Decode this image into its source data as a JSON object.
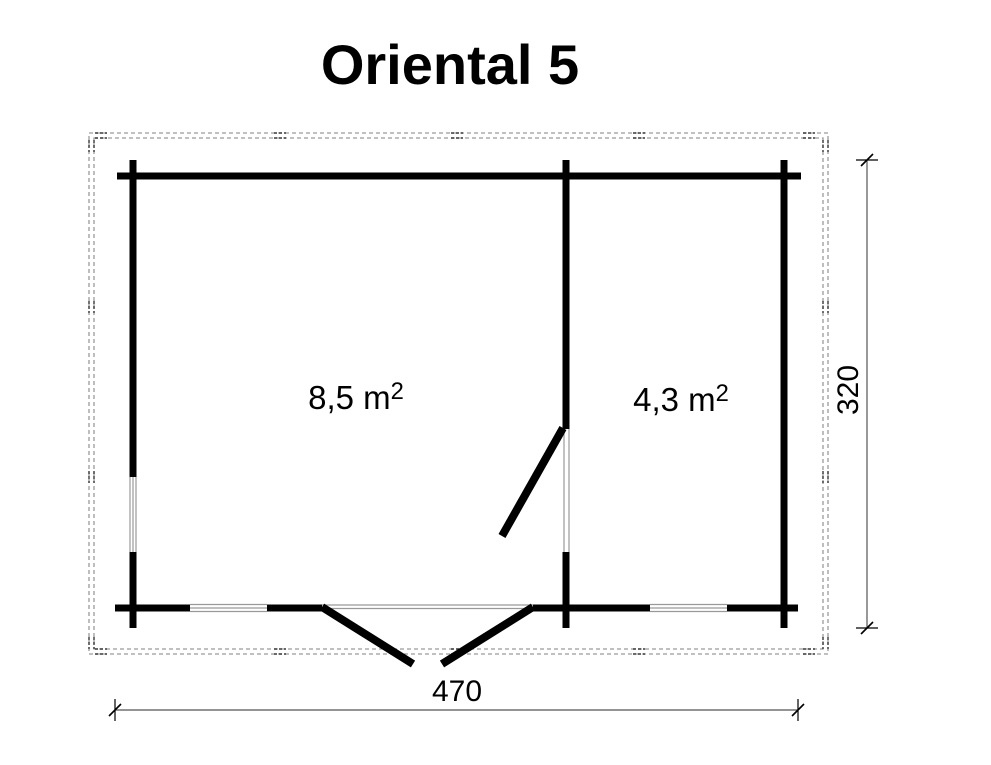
{
  "title": "Oriental 5",
  "rooms": [
    {
      "id": "main-room",
      "area_label": "8,5 m",
      "area_exponent": "2"
    },
    {
      "id": "second-room",
      "area_label": "4,3 m",
      "area_exponent": "2"
    }
  ],
  "dimensions": {
    "width_label": "470",
    "height_label": "320"
  },
  "colors": {
    "wall": "#000000",
    "door_leaf": "#000000",
    "window_line": "#999999",
    "roof_overhang_dash": "#9a9a9a",
    "roof_overhang_mark": "#3a3a3a",
    "dimension_line": "#555555",
    "dimension_tick": "#000000",
    "text": "#000000",
    "background": "#ffffff"
  }
}
